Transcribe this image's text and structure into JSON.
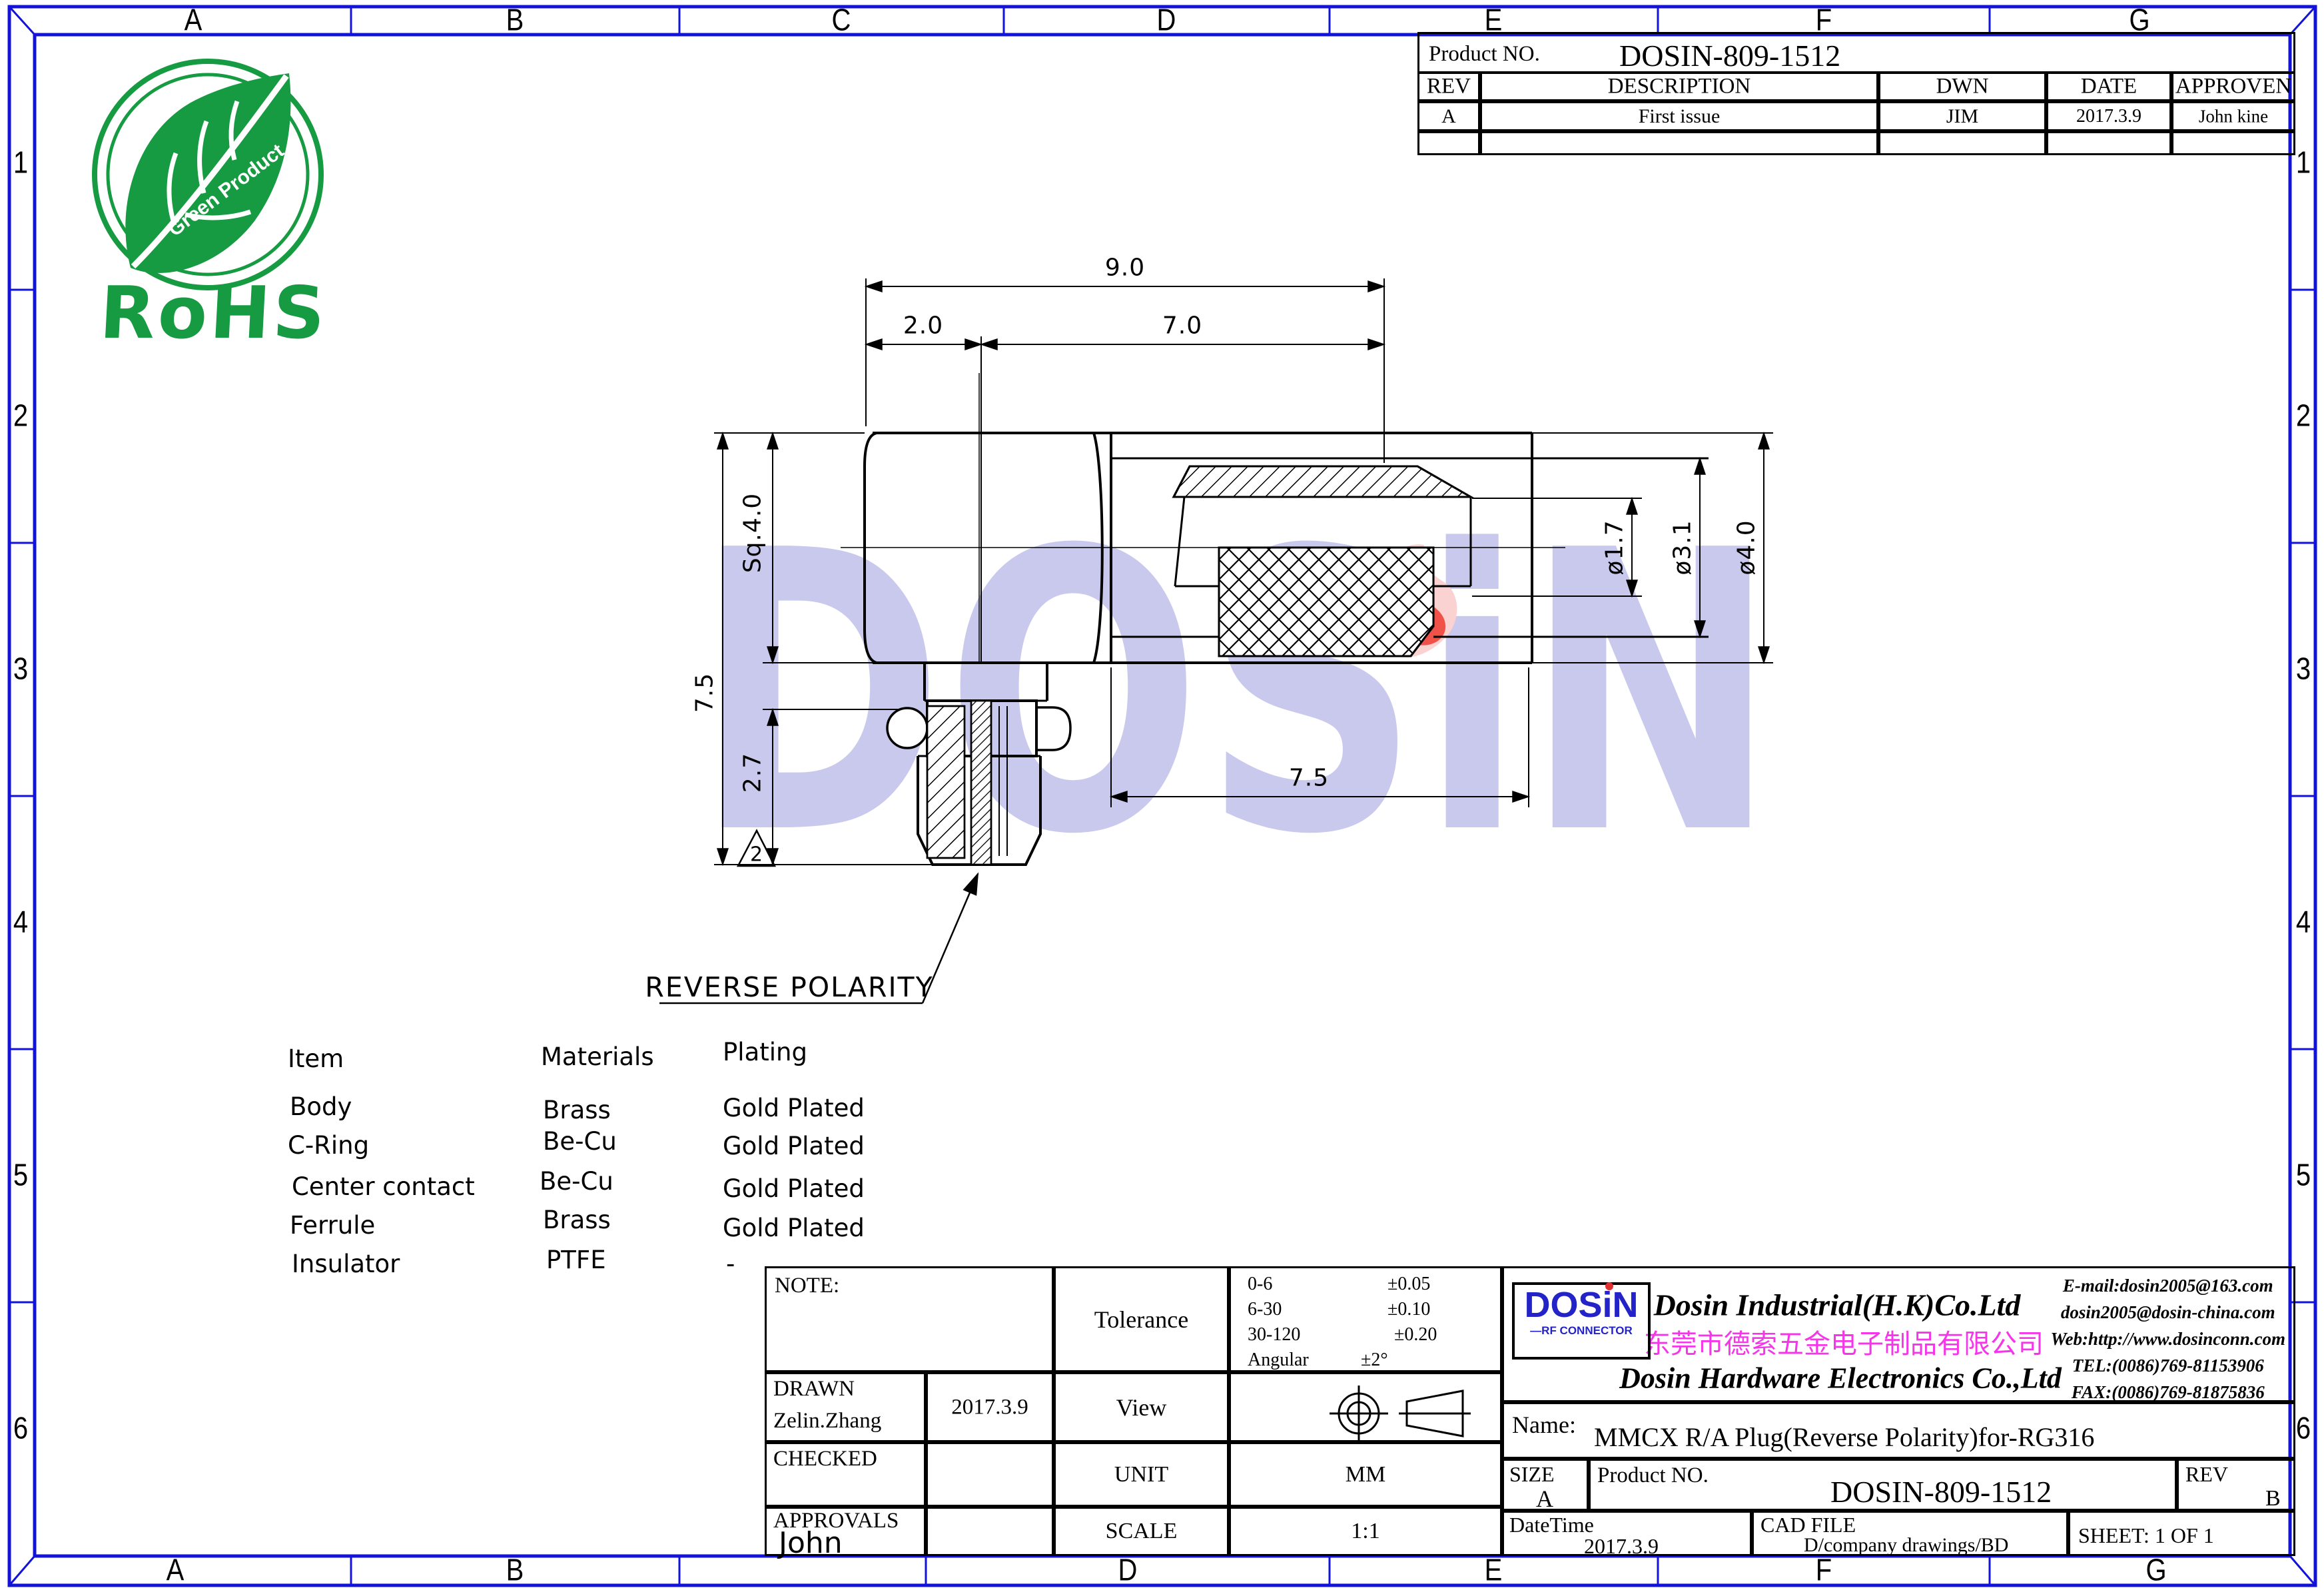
{
  "grid": {
    "top": [
      "A",
      "B",
      "C",
      "D",
      "E",
      "F",
      "G"
    ],
    "bottom": [
      "A",
      "B",
      "D",
      "E",
      "F",
      "G"
    ],
    "left": [
      "1",
      "2",
      "3",
      "4",
      "5",
      "6"
    ],
    "right": [
      "1",
      "2",
      "3",
      "4",
      "5",
      "6"
    ]
  },
  "colors": {
    "frame_blue": "#1212d8",
    "logo_blue": "#2323c8",
    "magenta": "#f535e8",
    "rohs_green": "#169b42",
    "watermark": "#c9c9ee",
    "flame_pink": "#fbd2d2",
    "flame_red": "#f0524a"
  },
  "revision_table": {
    "product_no_label": "Product NO.",
    "product_no": "DOSIN-809-1512",
    "headers": {
      "rev": "REV",
      "description": "DESCRIPTION",
      "dwn": "DWN",
      "date": "DATE",
      "approven": "APPROVEN"
    },
    "row": {
      "rev": "A",
      "description": "First issue",
      "dwn": "JIM",
      "date": "2017.3.9",
      "approven": "John kine"
    }
  },
  "rohs": {
    "title": "RoHS",
    "leaf_text": "Green Product"
  },
  "watermark": {
    "text": "DOSiN"
  },
  "materials_table": {
    "headers": [
      "Item",
      "Materials",
      "Plating"
    ],
    "rows": [
      [
        "Body",
        "Brass",
        "Gold Plated"
      ],
      [
        "C-Ring",
        "Be-Cu",
        "Gold Plated"
      ],
      [
        "Center contact",
        "Be-Cu",
        "Gold Plated"
      ],
      [
        "Ferrule",
        "Brass",
        "Gold Plated"
      ],
      [
        "Insulator",
        "PTFE",
        "-"
      ]
    ]
  },
  "dimensions": {
    "total_length": "9.0",
    "front_length": "2.0",
    "rear_length": "7.0",
    "body_square": "Sq.4.0",
    "total_height": "7.5",
    "lower_height": "2.7",
    "shell_length": "7.5",
    "dia_inner": "ø1.7",
    "dia_mid": "ø3.1",
    "dia_outer": "ø4.0",
    "surface_mark": "2",
    "callout": "REVERSE POLARITY"
  },
  "title_block": {
    "note_label": "NOTE:",
    "tolerance_label": "Tolerance",
    "tolerances": [
      {
        "range": "0-6",
        "value": "±0.05"
      },
      {
        "range": "6-30",
        "value": "±0.10"
      },
      {
        "range": "30-120",
        "value": "±0.20"
      },
      {
        "range": "Angular",
        "value": "±2°"
      }
    ],
    "drawn_label": "DRAWN",
    "drawn_name": "Zelin.Zhang",
    "drawn_date": "2017.3.9",
    "checked_label": "CHECKED",
    "approvals_label": "APPROVALS",
    "approvals_name": "John",
    "view_label": "View",
    "unit_label": "UNIT",
    "unit_value": "MM",
    "scale_label": "SCALE",
    "scale_value": "1:1",
    "company": {
      "logo_text": "DOSiN",
      "logo_sub": "—RF CONNECTOR",
      "name_en": "Dosin Industrial(H.K)Co.Ltd",
      "name_cn": "东莞市德索五金电子制品有限公司",
      "name_en2": "Dosin Hardware Electronics  Co.,Ltd",
      "contacts": [
        "E-mail:dosin2005@163.com",
        "dosin2005@dosin-china.com",
        "Web:http://www.dosinconn.com",
        "TEL:(0086)769-81153906",
        "FAX:(0086)769-81875836"
      ]
    },
    "name_label": "Name:",
    "name_value": "MMCX R/A Plug(Reverse Polarity)for-RG316",
    "size_label": "SIZE",
    "size_value": "A",
    "product_no_label": "Product NO.",
    "product_no": "DOSIN-809-1512",
    "rev_label": "REV",
    "rev_value": "B",
    "datetime_label": "DateTime",
    "datetime_value": "2017.3.9",
    "cadfile_label": "CAD FILE",
    "cadfile_value": "D/company drawings/BD",
    "sheet": "SHEET:  1 OF 1"
  }
}
